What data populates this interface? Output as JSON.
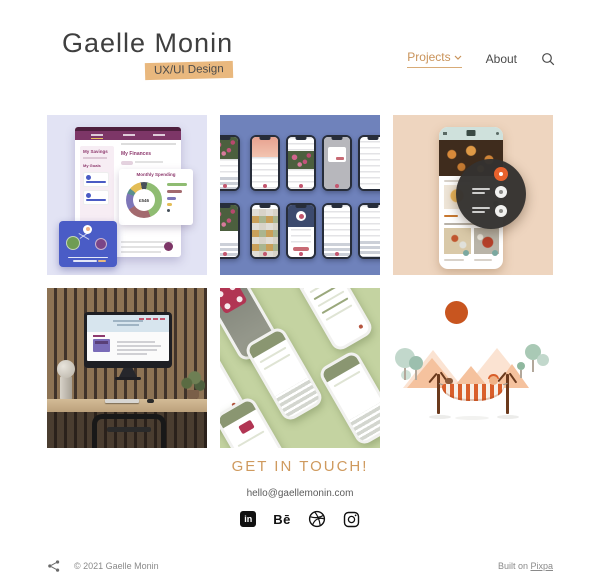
{
  "header": {
    "logo": "Gaelle Monin",
    "tagline": "UX/UI Design",
    "nav": {
      "projects": "Projects",
      "about": "About"
    }
  },
  "projects": [
    {
      "name": "finance-dashboard",
      "mock": {
        "savings_title": "My Savings",
        "goals_title": "My Goals",
        "finances_title": "My Finances",
        "chart_title": "Monthly Spending",
        "chart_amount": "£546"
      }
    },
    {
      "name": "mobile-app-screens-blue"
    },
    {
      "name": "recipe-app"
    },
    {
      "name": "desk-website-mockup"
    },
    {
      "name": "mobile-app-screens-green"
    },
    {
      "name": "vacation-illustration"
    }
  ],
  "contact": {
    "heading": "GET IN TOUCH!",
    "email": "hello@gaellemonin.com"
  },
  "social": [
    {
      "name": "linkedin",
      "label": "in"
    },
    {
      "name": "behance",
      "label": "Bē"
    },
    {
      "name": "dribbble"
    },
    {
      "name": "instagram"
    }
  ],
  "footer": {
    "copyright": "© 2021 Gaelle Monin",
    "built_on_prefix": "Built on ",
    "built_on_link": "Pixpa"
  },
  "colors": {
    "accent": "#cf9a5e",
    "badge_bg": "#e9b87e",
    "tile1_bg": "#e2e3f4",
    "tile2_bg": "#6f82bb",
    "tile3_bg": "#eed5bf",
    "tile5_bg": "#c4d3a1"
  }
}
